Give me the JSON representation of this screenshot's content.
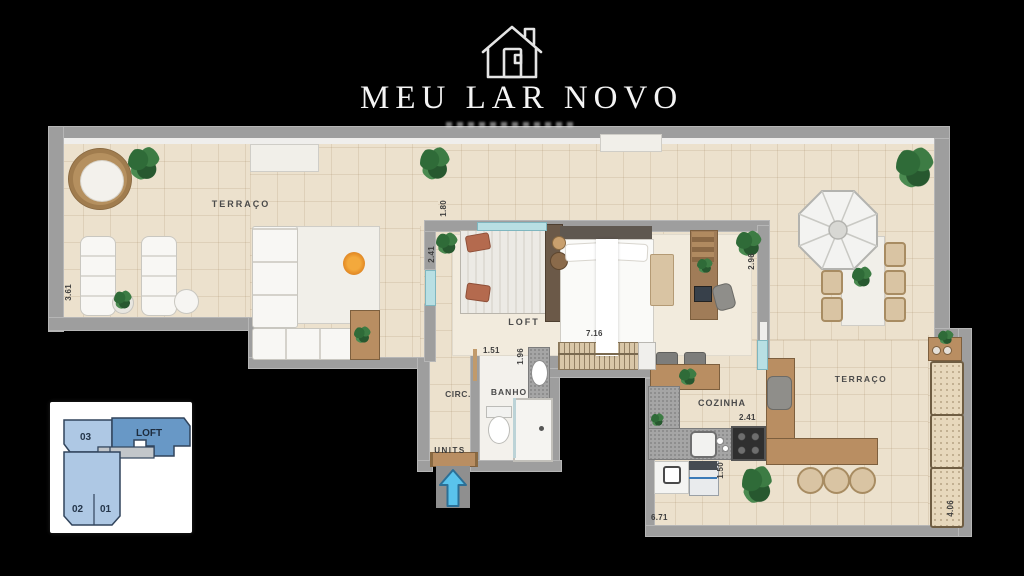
{
  "logo": {
    "title": "MEU LAR NOVO",
    "icon": "house-logo-icon"
  },
  "plan": {
    "room_labels": {
      "terrace_left": "TERRAÇO",
      "loft": "LOFT",
      "circulation": "CIRC.",
      "bathroom": "BANHO",
      "kitchen": "COZINHA",
      "terrace_right": "TERRAÇO"
    },
    "entrance_label": "UNITS",
    "dimensions": {
      "terrace_left_side": "3.61",
      "loft_top_opening": "1.80",
      "loft_left_opening": "2.41",
      "closet_run": "7.16",
      "bath_width": "1.51",
      "bath_depth": "1.96",
      "loft_right_side": "2.96",
      "kitchen_counter": "2.41",
      "kitchen_side": "1.50",
      "kitchen_width": "6.71",
      "planter_run": "4.06"
    }
  },
  "key_plan": {
    "unit_03": "03",
    "unit_loft": "LOFT",
    "unit_02": "02",
    "unit_01": "01",
    "highlighted_unit": "LOFT"
  },
  "icons": {
    "entrance_arrow": "arrow-up-icon",
    "logo": "house-logo-icon"
  },
  "colors": {
    "background": "#000000",
    "floor": "#ece1cd",
    "wall": "#9e9e9e",
    "wood": "#b98e62",
    "glass": "#b8dfe3",
    "fire": "#e8922a",
    "arrow_blue": "#5ac3ec",
    "keyplan_unit": "#aec8e4",
    "keyplan_highlight": "#6898c6"
  }
}
